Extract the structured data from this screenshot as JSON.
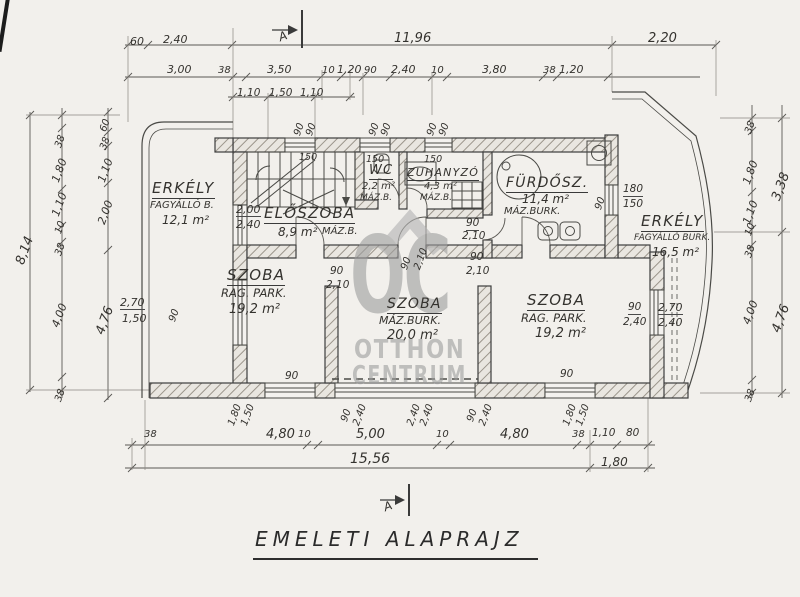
{
  "title": "EMELETI ALAPRAJZ",
  "watermark": {
    "logo": "OC",
    "name_top": "OTTHON",
    "name_bottom": "CENTRUM"
  },
  "labels": [
    {
      "t": "60",
      "x": 130,
      "y": 36
    },
    {
      "t": "2,40",
      "x": 163,
      "y": 34
    },
    {
      "t": "11,96",
      "x": 394,
      "y": 32,
      "s": 13
    },
    {
      "t": "2,20",
      "x": 648,
      "y": 32,
      "s": 13
    },
    {
      "t": "3,00",
      "x": 167,
      "y": 64
    },
    {
      "t": "38",
      "x": 218,
      "y": 66,
      "s": 10
    },
    {
      "t": "3,50",
      "x": 267,
      "y": 64
    },
    {
      "t": "10",
      "x": 322,
      "y": 66,
      "s": 10
    },
    {
      "t": "1,20",
      "x": 337,
      "y": 64
    },
    {
      "t": "90",
      "x": 364,
      "y": 66,
      "s": 10
    },
    {
      "t": "2,40",
      "x": 391,
      "y": 64
    },
    {
      "t": "10",
      "x": 431,
      "y": 66,
      "s": 10
    },
    {
      "t": "3,80",
      "x": 482,
      "y": 64
    },
    {
      "t": "38",
      "x": 543,
      "y": 66,
      "s": 10
    },
    {
      "t": "1,20",
      "x": 559,
      "y": 64
    },
    {
      "t": "1,10",
      "x": 237,
      "y": 88,
      "s": 10.5
    },
    {
      "t": "1,50",
      "x": 269,
      "y": 88,
      "s": 10.5
    },
    {
      "t": "1,10",
      "x": 300,
      "y": 88,
      "s": 10.5
    },
    {
      "t": "8,14",
      "x": 14,
      "y": 262,
      "r": -70,
      "s": 13
    },
    {
      "t": "38",
      "x": 54,
      "y": 146,
      "r": -70,
      "s": 10
    },
    {
      "t": "1,80",
      "x": 50,
      "y": 180,
      "r": -70
    },
    {
      "t": "1,10",
      "x": 50,
      "y": 214,
      "r": -70
    },
    {
      "t": "10",
      "x": 54,
      "y": 232,
      "r": -70,
      "s": 10
    },
    {
      "t": "38",
      "x": 54,
      "y": 254,
      "r": -70,
      "s": 10
    },
    {
      "t": "4,00",
      "x": 50,
      "y": 325,
      "r": -70
    },
    {
      "t": "38",
      "x": 54,
      "y": 400,
      "r": -70,
      "s": 10
    },
    {
      "t": "60",
      "x": 99,
      "y": 130,
      "r": -70,
      "s": 10
    },
    {
      "t": "38",
      "x": 99,
      "y": 148,
      "r": -70,
      "s": 10
    },
    {
      "t": "1,10",
      "x": 96,
      "y": 180,
      "r": -70
    },
    {
      "t": "2,00",
      "x": 96,
      "y": 222,
      "r": -70
    },
    {
      "t": "4,76",
      "x": 94,
      "y": 332,
      "r": -70,
      "s": 13
    },
    {
      "t": "38",
      "x": 744,
      "y": 132,
      "r": -70,
      "s": 10
    },
    {
      "t": "1,80",
      "x": 741,
      "y": 182,
      "r": -70
    },
    {
      "t": "1,10",
      "x": 741,
      "y": 222,
      "r": -70
    },
    {
      "t": "10",
      "x": 744,
      "y": 234,
      "r": -70,
      "s": 10
    },
    {
      "t": "38",
      "x": 744,
      "y": 256,
      "r": -70,
      "s": 10
    },
    {
      "t": "4,00",
      "x": 741,
      "y": 322,
      "r": -70
    },
    {
      "t": "38",
      "x": 744,
      "y": 400,
      "r": -70,
      "s": 10
    },
    {
      "t": "3,38",
      "x": 770,
      "y": 198,
      "r": -70,
      "s": 13
    },
    {
      "t": "4,76",
      "x": 770,
      "y": 330,
      "r": -70,
      "s": 13
    },
    {
      "t": "38",
      "x": 144,
      "y": 430,
      "s": 10
    },
    {
      "t": "4,80",
      "x": 266,
      "y": 428,
      "s": 13
    },
    {
      "t": "10",
      "x": 298,
      "y": 430,
      "s": 10
    },
    {
      "t": "5,00",
      "x": 356,
      "y": 428,
      "s": 13
    },
    {
      "t": "10",
      "x": 436,
      "y": 430,
      "s": 10
    },
    {
      "t": "4,80",
      "x": 500,
      "y": 428,
      "s": 13
    },
    {
      "t": "38",
      "x": 572,
      "y": 430,
      "s": 10
    },
    {
      "t": "1,10",
      "x": 592,
      "y": 428,
      "s": 10.5
    },
    {
      "t": "80",
      "x": 626,
      "y": 428,
      "s": 10.5
    },
    {
      "t": "15,56",
      "x": 350,
      "y": 452,
      "s": 14
    },
    {
      "t": "1,80",
      "x": 601,
      "y": 456,
      "s": 12
    },
    {
      "t": "1,80",
      "x": 227,
      "y": 424,
      "r": -70,
      "s": 10
    },
    {
      "t": "1,50",
      "x": 240,
      "y": 424,
      "r": -70,
      "s": 10
    },
    {
      "t": "90",
      "x": 340,
      "y": 420,
      "r": -70,
      "s": 10
    },
    {
      "t": "2,40",
      "x": 352,
      "y": 424,
      "r": -70,
      "s": 10
    },
    {
      "t": "2,40",
      "x": 406,
      "y": 424,
      "r": -70,
      "s": 10
    },
    {
      "t": "2,40",
      "x": 419,
      "y": 424,
      "r": -70,
      "s": 10
    },
    {
      "t": "90",
      "x": 466,
      "y": 420,
      "r": -70,
      "s": 10
    },
    {
      "t": "2,40",
      "x": 478,
      "y": 424,
      "r": -70,
      "s": 10
    },
    {
      "t": "1,80",
      "x": 562,
      "y": 424,
      "r": -70,
      "s": 10
    },
    {
      "t": "1,50",
      "x": 575,
      "y": 424,
      "r": -70,
      "s": 10
    },
    {
      "t": "90",
      "x": 293,
      "y": 134,
      "r": -70,
      "s": 10
    },
    {
      "t": "90",
      "x": 305,
      "y": 134,
      "r": -70,
      "s": 10
    },
    {
      "t": "90",
      "x": 368,
      "y": 134,
      "r": -70,
      "s": 10
    },
    {
      "t": "90",
      "x": 380,
      "y": 134,
      "r": -70,
      "s": 10
    },
    {
      "t": "90",
      "x": 426,
      "y": 134,
      "r": -70,
      "s": 10
    },
    {
      "t": "90",
      "x": 438,
      "y": 134,
      "r": -70,
      "s": 10
    },
    {
      "t": "150",
      "x": 299,
      "y": 153,
      "s": 9.5
    },
    {
      "t": "150",
      "x": 366,
      "y": 155,
      "s": 9.5
    },
    {
      "t": "150",
      "x": 424,
      "y": 155,
      "s": 9.5
    },
    {
      "t": "2,00",
      "x": 236,
      "y": 204,
      "c": "ft"
    },
    {
      "t": "2,40",
      "x": 236,
      "y": 219
    },
    {
      "t": "ELŐSZOBA",
      "x": 264,
      "y": 206,
      "s": 15,
      "c": "room ul",
      "n": "room-label-eloszoba"
    },
    {
      "t": "8,9 m²",
      "x": 278,
      "y": 226,
      "s": 12,
      "n": "room-area-eloszoba"
    },
    {
      "t": "MÁZ.B.",
      "x": 322,
      "y": 227,
      "s": 10
    },
    {
      "t": "WC",
      "x": 369,
      "y": 164,
      "s": 13,
      "c": "room ul",
      "n": "room-label-wc"
    },
    {
      "t": "2,2 m²",
      "x": 362,
      "y": 182,
      "s": 10,
      "n": "room-area-wc"
    },
    {
      "t": "MÁZ.B.",
      "x": 360,
      "y": 194,
      "s": 9
    },
    {
      "t": "ZUHANYZÓ",
      "x": 407,
      "y": 167,
      "s": 11,
      "c": "room ul",
      "n": "room-label-zuhanyzo"
    },
    {
      "t": "4,3 m²",
      "x": 424,
      "y": 182,
      "s": 10,
      "n": "room-area-zuhanyzo"
    },
    {
      "t": "MÁZ.B.",
      "x": 420,
      "y": 194,
      "s": 9
    },
    {
      "t": "FÜRDŐSZ.",
      "x": 506,
      "y": 176,
      "s": 14,
      "c": "room ul",
      "n": "room-label-furdoszoba"
    },
    {
      "t": "11,4 m²",
      "x": 522,
      "y": 193,
      "s": 12,
      "n": "room-area-furdoszoba"
    },
    {
      "t": "MÁZ.BURK.",
      "x": 504,
      "y": 207,
      "s": 10
    },
    {
      "t": "90",
      "x": 594,
      "y": 208,
      "r": -70,
      "s": 10
    },
    {
      "t": "180",
      "x": 623,
      "y": 184,
      "s": 10.5,
      "c": "ft"
    },
    {
      "t": "150",
      "x": 623,
      "y": 199,
      "s": 10.5
    },
    {
      "t": "ERKÉLY",
      "x": 641,
      "y": 214,
      "s": 15,
      "c": "room ul",
      "n": "room-label-erkely-right"
    },
    {
      "t": "FAGYÁLLÓ BURK.",
      "x": 634,
      "y": 234,
      "s": 9
    },
    {
      "t": "16,5 m²",
      "x": 652,
      "y": 246,
      "s": 12,
      "n": "room-area-erkely-right"
    },
    {
      "t": "ERKÉLY",
      "x": 152,
      "y": 181,
      "s": 15,
      "c": "room ul",
      "n": "room-label-erkely-left"
    },
    {
      "t": "FAGYÁLLÓ B.",
      "x": 150,
      "y": 201,
      "s": 10
    },
    {
      "t": "12,1 m²",
      "x": 162,
      "y": 214,
      "s": 12,
      "n": "room-area-erkely-left"
    },
    {
      "t": "SZOBA",
      "x": 227,
      "y": 268,
      "s": 15,
      "c": "room ul",
      "n": "room-label-szoba-1"
    },
    {
      "t": "RAG. PARK.",
      "x": 221,
      "y": 288,
      "s": 11.5
    },
    {
      "t": "19,2 m²",
      "x": 229,
      "y": 303,
      "s": 13,
      "n": "room-area-szoba-1"
    },
    {
      "t": "SZOBA",
      "x": 387,
      "y": 297,
      "s": 14,
      "c": "room ul",
      "n": "room-label-szoba-2"
    },
    {
      "t": "MÁZ.BURK.",
      "x": 379,
      "y": 315,
      "s": 11
    },
    {
      "t": "20,0 m²",
      "x": 387,
      "y": 329,
      "s": 13,
      "n": "room-area-szoba-2"
    },
    {
      "t": "SZOBA",
      "x": 527,
      "y": 293,
      "s": 15,
      "c": "room ul",
      "n": "room-label-szoba-3"
    },
    {
      "t": "RAG. PARK.",
      "x": 521,
      "y": 313,
      "s": 11.5
    },
    {
      "t": "19,2 m²",
      "x": 535,
      "y": 327,
      "s": 13,
      "n": "room-area-szoba-3"
    },
    {
      "t": "90",
      "x": 330,
      "y": 266,
      "s": 10.5
    },
    {
      "t": "2,10",
      "x": 326,
      "y": 280,
      "s": 10.5
    },
    {
      "t": "90",
      "x": 470,
      "y": 252,
      "s": 10.5
    },
    {
      "t": "2,10",
      "x": 466,
      "y": 266,
      "s": 10.5
    },
    {
      "t": "90",
      "x": 400,
      "y": 268,
      "r": -70,
      "s": 10
    },
    {
      "t": "2,10",
      "x": 413,
      "y": 268,
      "r": -70,
      "s": 10
    },
    {
      "t": "90",
      "x": 466,
      "y": 218,
      "s": 10.5,
      "c": "ft"
    },
    {
      "t": "2,10",
      "x": 462,
      "y": 231,
      "s": 10.5
    },
    {
      "t": "2,70",
      "x": 120,
      "y": 297,
      "c": "ft"
    },
    {
      "t": "1,50",
      "x": 122,
      "y": 313
    },
    {
      "t": "90",
      "x": 168,
      "y": 320,
      "r": -70,
      "s": 10
    },
    {
      "t": "90",
      "x": 628,
      "y": 302,
      "s": 10.5,
      "c": "ft"
    },
    {
      "t": "2,40",
      "x": 623,
      "y": 317,
      "s": 10.5
    },
    {
      "t": "2,70",
      "x": 658,
      "y": 302,
      "c": "ft"
    },
    {
      "t": "2,40",
      "x": 658,
      "y": 317
    },
    {
      "t": "90",
      "x": 285,
      "y": 371,
      "s": 10.5
    },
    {
      "t": "90",
      "x": 560,
      "y": 369,
      "s": 10.5
    },
    {
      "t": "A",
      "x": 277,
      "y": 32,
      "s": 12,
      "r": -20,
      "n": "section-marker-letter"
    },
    {
      "t": "A",
      "x": 382,
      "y": 502,
      "s": 12,
      "r": -20,
      "n": "section-marker-letter"
    }
  ]
}
